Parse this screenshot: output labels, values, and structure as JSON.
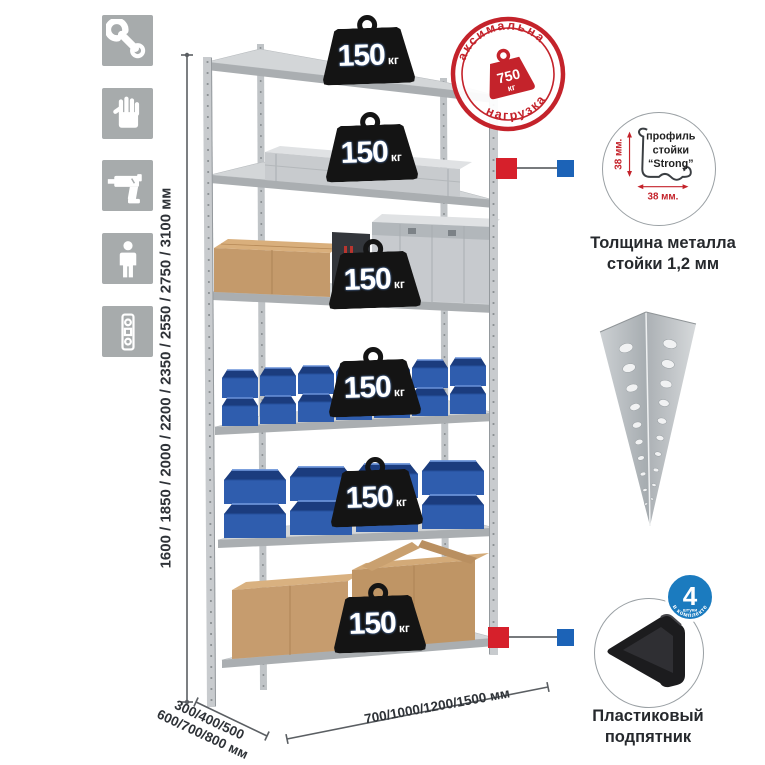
{
  "page": {
    "background": "#ffffff"
  },
  "colors": {
    "stamp_red": "#c4232b",
    "connector_red": "#d6202b",
    "connector_blue": "#1c63b7",
    "badge_blue": "#1b7bbf",
    "bin_blue": "#2f5dae",
    "metal_gray": "#c6c9cc",
    "icon_bg": "#a7abac",
    "weight_black": "#141414"
  },
  "icons_panel": {
    "items": [
      {
        "name": "wrench-icon"
      },
      {
        "name": "gloves-icon"
      },
      {
        "name": "drill-icon"
      },
      {
        "name": "assembly-person-icon"
      },
      {
        "name": "level-icon"
      }
    ]
  },
  "height_dimension": {
    "label": "1600 / 1850 / 2000 / 2200 / 2350 / 2550 / 2750 / 3100 мм"
  },
  "rack": {
    "shelf_count": 6,
    "shelf_load": {
      "value": "150",
      "unit": "кг"
    }
  },
  "max_load_stamp": {
    "arc_top": "максимальная",
    "arc_bottom": "нагрузка",
    "value": "750",
    "unit": "кг"
  },
  "profile_detail": {
    "line1": "профиль",
    "line2": "стойки",
    "line3": "“Strong”",
    "dim_vertical": "38 мм.",
    "dim_horizontal": "38 мм.",
    "caption_line1": "Толщина металла",
    "caption_line2": "стойки 1,2 мм"
  },
  "foot_detail": {
    "badge_value": "4",
    "badge_unit": "штуки",
    "badge_arc": "в комплекте",
    "caption_line1": "Пластиковый",
    "caption_line2": "подпятник"
  },
  "depth_dimension": {
    "line1": "300/400/500",
    "line2": "600/700/800 мм"
  },
  "width_dimension": {
    "label": "700/1000/1200/1500 мм"
  }
}
